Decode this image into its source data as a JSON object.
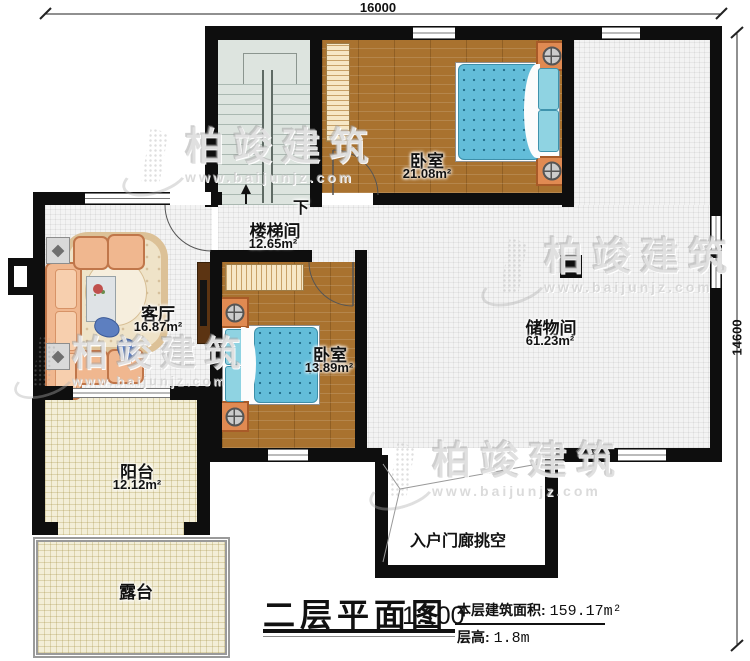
{
  "watermark": {
    "brand": "柏竣建筑",
    "url": "www.baijunjz.com"
  },
  "dimensions": {
    "width": "16000",
    "height": "14600"
  },
  "rooms": {
    "bedroom_top": {
      "name": "卧室",
      "area": "21.08m²"
    },
    "stairwell": {
      "name": "楼梯间",
      "area": "12.65m²"
    },
    "living_room": {
      "name": "客厅",
      "area": "16.87m²"
    },
    "bedroom_mid": {
      "name": "卧室",
      "area": "13.89m²"
    },
    "storage": {
      "name": "储物间",
      "area": "61.23m²"
    },
    "balcony": {
      "name": "阳台",
      "area": "12.12m²"
    },
    "terrace": {
      "name": "露台"
    },
    "porch": {
      "name": "入户门廊挑空"
    }
  },
  "stairs": {
    "down_label": "下"
  },
  "title_block": {
    "title": "二层平面图",
    "scale": "1:100",
    "floor_area_label": "本层建筑面积:",
    "floor_area_value": "159.17m²",
    "floor_height_label": "层高:",
    "floor_height_value": "1.8m"
  }
}
